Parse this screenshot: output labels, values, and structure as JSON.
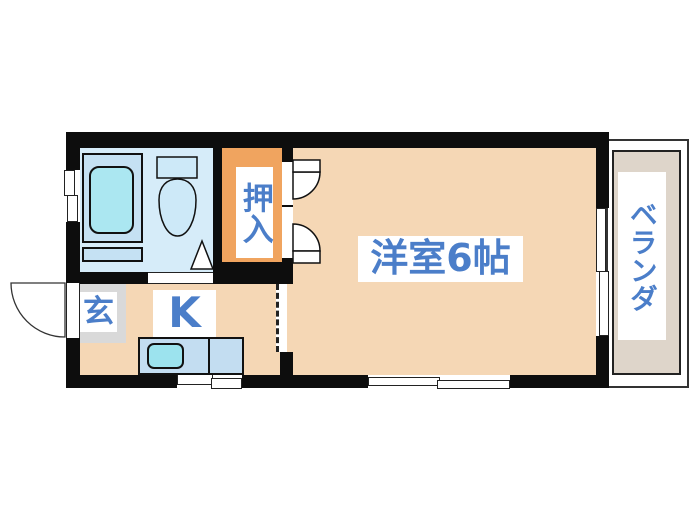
{
  "floorplan": {
    "rooms": {
      "main": {
        "label": "洋室6帖"
      },
      "closet": {
        "label": "押入"
      },
      "kitchen": {
        "label": "K"
      },
      "entrance": {
        "label": "玄"
      },
      "veranda": {
        "label": "ベランダ"
      }
    },
    "colors": {
      "wall": "#0d0d0d",
      "room_fill": "#f5d7b5",
      "closet_fill": "#f0a45f",
      "entrance_fill": "#d9d9d9",
      "bathroom_fill": "#d6ecf9",
      "fixture_fill": "#c5e1f3",
      "tub_fill": "#abe7f1",
      "sink_fill": "#9ce3ee",
      "counter_fill": "#c3ddf1",
      "veranda_fill": "#ded5ca",
      "label_text": "#4b7ec9",
      "label_bg": "#ffffff"
    }
  }
}
